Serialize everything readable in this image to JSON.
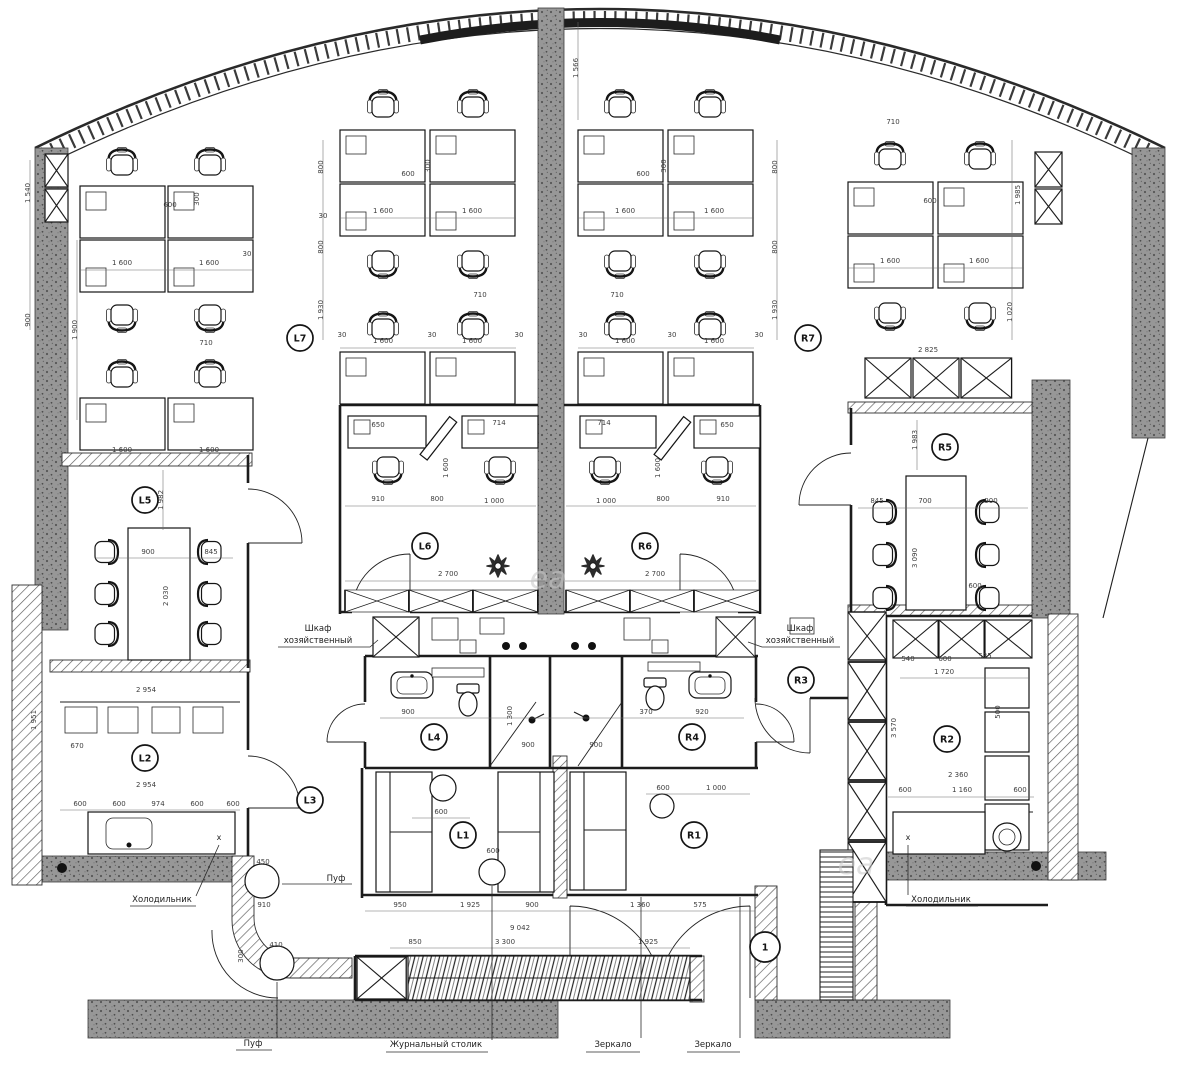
{
  "plan": {
    "title_hint": "office floor plan",
    "colors": {
      "concrete": "#979797",
      "speckle": "#555555",
      "line": "#1c1c1c",
      "hatch": "#5a5a5a"
    }
  },
  "annotations": {
    "utility_cabinet_line1": "Шкаф",
    "utility_cabinet_line2": "хозяйственный",
    "pouf": "Пуф",
    "pouf2": "Пуф",
    "coffee_table": "Журнальный столик",
    "mirror1": "Зеркало",
    "mirror2": "Зеркало",
    "fridge_left": "Холодильник",
    "fridge_right": "Холодильник",
    "x_mark": "x",
    "watermark_fragment": "еа"
  },
  "rooms": [
    {
      "id": "L7",
      "x": 300,
      "y": 338,
      "r": 13
    },
    {
      "id": "R7",
      "x": 808,
      "y": 338,
      "r": 13
    },
    {
      "id": "L6",
      "x": 425,
      "y": 546,
      "r": 13
    },
    {
      "id": "R6",
      "x": 645,
      "y": 546,
      "r": 13
    },
    {
      "id": "L5",
      "x": 145,
      "y": 500,
      "r": 13
    },
    {
      "id": "R5",
      "x": 945,
      "y": 447,
      "r": 13
    },
    {
      "id": "L4",
      "x": 434,
      "y": 737,
      "r": 13
    },
    {
      "id": "R4",
      "x": 692,
      "y": 737,
      "r": 13
    },
    {
      "id": "L3",
      "x": 310,
      "y": 800,
      "r": 13
    },
    {
      "id": "R3",
      "x": 801,
      "y": 680,
      "r": 13
    },
    {
      "id": "L2",
      "x": 145,
      "y": 758,
      "r": 13
    },
    {
      "id": "R2",
      "x": 947,
      "y": 739,
      "r": 13
    },
    {
      "id": "L1",
      "x": 463,
      "y": 835,
      "r": 13
    },
    {
      "id": "R1",
      "x": 694,
      "y": 835,
      "r": 13
    },
    {
      "id": "1",
      "x": 765,
      "y": 947,
      "r": 15
    }
  ],
  "dimensions": [
    {
      "v": "1 540",
      "x": 30,
      "y": 193,
      "r": -90
    },
    {
      "v": "900",
      "x": 30,
      "y": 320,
      "r": -90
    },
    {
      "v": "1 900",
      "x": 77,
      "y": 330,
      "r": -90
    },
    {
      "v": "600",
      "x": 170,
      "y": 207,
      "r": 0
    },
    {
      "v": "300",
      "x": 199,
      "y": 199,
      "r": -90
    },
    {
      "v": "1 600",
      "x": 122,
      "y": 265,
      "r": 0
    },
    {
      "v": "1 600",
      "x": 209,
      "y": 265,
      "r": 0
    },
    {
      "v": "30",
      "x": 247,
      "y": 256,
      "r": 0
    },
    {
      "v": "710",
      "x": 206,
      "y": 345,
      "r": 0
    },
    {
      "v": "1 600",
      "x": 122,
      "y": 452,
      "r": 0
    },
    {
      "v": "1 600",
      "x": 209,
      "y": 452,
      "r": 0
    },
    {
      "v": "800",
      "x": 323,
      "y": 167,
      "r": -90
    },
    {
      "v": "800",
      "x": 323,
      "y": 247,
      "r": -90
    },
    {
      "v": "1 930",
      "x": 323,
      "y": 310,
      "r": -90
    },
    {
      "v": "30",
      "x": 323,
      "y": 218,
      "r": 0
    },
    {
      "v": "600",
      "x": 408,
      "y": 176,
      "r": 0
    },
    {
      "v": "300",
      "x": 430,
      "y": 166,
      "r": -90
    },
    {
      "v": "1 600",
      "x": 383,
      "y": 213,
      "r": 0
    },
    {
      "v": "1 600",
      "x": 472,
      "y": 213,
      "r": 0
    },
    {
      "v": "1 566",
      "x": 578,
      "y": 68,
      "r": -90
    },
    {
      "v": "1 600",
      "x": 625,
      "y": 213,
      "r": 0
    },
    {
      "v": "1 600",
      "x": 714,
      "y": 213,
      "r": 0
    },
    {
      "v": "600",
      "x": 643,
      "y": 176,
      "r": 0
    },
    {
      "v": "300",
      "x": 666,
      "y": 166,
      "r": -90
    },
    {
      "v": "800",
      "x": 777,
      "y": 167,
      "r": -90
    },
    {
      "v": "800",
      "x": 777,
      "y": 247,
      "r": -90
    },
    {
      "v": "1 930",
      "x": 777,
      "y": 310,
      "r": -90
    },
    {
      "v": "710",
      "x": 480,
      "y": 297,
      "r": 0
    },
    {
      "v": "710",
      "x": 617,
      "y": 297,
      "r": 0
    },
    {
      "v": "30",
      "x": 342,
      "y": 337,
      "r": 0
    },
    {
      "v": "30",
      "x": 432,
      "y": 337,
      "r": 0
    },
    {
      "v": "30",
      "x": 519,
      "y": 337,
      "r": 0
    },
    {
      "v": "1 600",
      "x": 383,
      "y": 343,
      "r": 0
    },
    {
      "v": "1 600",
      "x": 472,
      "y": 343,
      "r": 0
    },
    {
      "v": "1 600",
      "x": 625,
      "y": 343,
      "r": 0
    },
    {
      "v": "1 600",
      "x": 714,
      "y": 343,
      "r": 0
    },
    {
      "v": "30",
      "x": 583,
      "y": 337,
      "r": 0
    },
    {
      "v": "30",
      "x": 672,
      "y": 337,
      "r": 0
    },
    {
      "v": "30",
      "x": 759,
      "y": 337,
      "r": 0
    },
    {
      "v": "710",
      "x": 893,
      "y": 124,
      "r": 0
    },
    {
      "v": "1 600",
      "x": 890,
      "y": 263,
      "r": 0
    },
    {
      "v": "1 600",
      "x": 979,
      "y": 263,
      "r": 0
    },
    {
      "v": "600",
      "x": 930,
      "y": 203,
      "r": 0
    },
    {
      "v": "1 985",
      "x": 1020,
      "y": 195,
      "r": -90
    },
    {
      "v": "1 020",
      "x": 1012,
      "y": 312,
      "r": -90
    },
    {
      "v": "2 825",
      "x": 928,
      "y": 352,
      "r": 0
    },
    {
      "v": "1 982",
      "x": 163,
      "y": 500,
      "r": -90
    },
    {
      "v": "900",
      "x": 148,
      "y": 554,
      "r": 0
    },
    {
      "v": "845",
      "x": 211,
      "y": 554,
      "r": 0
    },
    {
      "v": "2 030",
      "x": 168,
      "y": 596,
      "r": -90
    },
    {
      "v": "1 983",
      "x": 917,
      "y": 440,
      "r": -90
    },
    {
      "v": "845",
      "x": 877,
      "y": 503,
      "r": 0
    },
    {
      "v": "700",
      "x": 925,
      "y": 503,
      "r": 0
    },
    {
      "v": "900",
      "x": 991,
      "y": 503,
      "r": 0
    },
    {
      "v": "3 090",
      "x": 917,
      "y": 558,
      "r": -90
    },
    {
      "v": "600",
      "x": 975,
      "y": 588,
      "r": 0
    },
    {
      "v": "650",
      "x": 378,
      "y": 427,
      "r": 0
    },
    {
      "v": "714",
      "x": 499,
      "y": 425,
      "r": 0
    },
    {
      "v": "714",
      "x": 604,
      "y": 425,
      "r": 0
    },
    {
      "v": "650",
      "x": 727,
      "y": 427,
      "r": 0
    },
    {
      "v": "1 600",
      "x": 448,
      "y": 468,
      "r": -90
    },
    {
      "v": "1 600",
      "x": 660,
      "y": 468,
      "r": -90
    },
    {
      "v": "910",
      "x": 378,
      "y": 501,
      "r": 0
    },
    {
      "v": "800",
      "x": 437,
      "y": 501,
      "r": 0
    },
    {
      "v": "1 000",
      "x": 494,
      "y": 503,
      "r": 0
    },
    {
      "v": "1 000",
      "x": 606,
      "y": 503,
      "r": 0
    },
    {
      "v": "800",
      "x": 663,
      "y": 501,
      "r": 0
    },
    {
      "v": "910",
      "x": 723,
      "y": 501,
      "r": 0
    },
    {
      "v": "2 700",
      "x": 448,
      "y": 576,
      "r": 0
    },
    {
      "v": "2 700",
      "x": 655,
      "y": 576,
      "r": 0
    },
    {
      "v": "900",
      "x": 408,
      "y": 714,
      "r": 0
    },
    {
      "v": "370",
      "x": 646,
      "y": 714,
      "r": 0
    },
    {
      "v": "920",
      "x": 702,
      "y": 714,
      "r": 0
    },
    {
      "v": "1 300",
      "x": 512,
      "y": 716,
      "r": -90
    },
    {
      "v": "900",
      "x": 528,
      "y": 747,
      "r": 0
    },
    {
      "v": "900",
      "x": 596,
      "y": 747,
      "r": 0
    },
    {
      "v": "2 954",
      "x": 146,
      "y": 692,
      "r": 0
    },
    {
      "v": "670",
      "x": 77,
      "y": 748,
      "r": 0
    },
    {
      "v": "2 954",
      "x": 146,
      "y": 787,
      "r": 0
    },
    {
      "v": "1 951",
      "x": 36,
      "y": 720,
      "r": -90
    },
    {
      "v": "600",
      "x": 80,
      "y": 806,
      "r": 0
    },
    {
      "v": "600",
      "x": 119,
      "y": 806,
      "r": 0
    },
    {
      "v": "974",
      "x": 158,
      "y": 806,
      "r": 0
    },
    {
      "v": "600",
      "x": 197,
      "y": 806,
      "r": 0
    },
    {
      "v": "600",
      "x": 233,
      "y": 806,
      "r": 0
    },
    {
      "v": "540",
      "x": 908,
      "y": 661,
      "r": 0
    },
    {
      "v": "600",
      "x": 945,
      "y": 661,
      "r": 0
    },
    {
      "v": "535",
      "x": 985,
      "y": 658,
      "r": 0
    },
    {
      "v": "1 720",
      "x": 944,
      "y": 674,
      "r": 0
    },
    {
      "v": "3 570",
      "x": 896,
      "y": 728,
      "r": -90
    },
    {
      "v": "500",
      "x": 1000,
      "y": 712,
      "r": -90
    },
    {
      "v": "2 360",
      "x": 958,
      "y": 777,
      "r": 0
    },
    {
      "v": "600",
      "x": 905,
      "y": 792,
      "r": 0
    },
    {
      "v": "1 160",
      "x": 962,
      "y": 792,
      "r": 0
    },
    {
      "v": "600",
      "x": 1020,
      "y": 792,
      "r": 0
    },
    {
      "v": "600",
      "x": 663,
      "y": 790,
      "r": 0
    },
    {
      "v": "1 000",
      "x": 716,
      "y": 790,
      "r": 0
    },
    {
      "v": "600",
      "x": 441,
      "y": 814,
      "r": 0
    },
    {
      "v": "600",
      "x": 493,
      "y": 853,
      "r": 0
    },
    {
      "v": "450",
      "x": 263,
      "y": 864,
      "r": 0
    },
    {
      "v": "910",
      "x": 264,
      "y": 907,
      "r": 0
    },
    {
      "v": "410",
      "x": 276,
      "y": 947,
      "r": 0
    },
    {
      "v": "300",
      "x": 243,
      "y": 956,
      "r": -90
    },
    {
      "v": "950",
      "x": 400,
      "y": 907,
      "r": 0
    },
    {
      "v": "1 925",
      "x": 470,
      "y": 907,
      "r": 0
    },
    {
      "v": "900",
      "x": 532,
      "y": 907,
      "r": 0
    },
    {
      "v": "1 360",
      "x": 640,
      "y": 907,
      "r": 0
    },
    {
      "v": "575",
      "x": 700,
      "y": 907,
      "r": 0
    },
    {
      "v": "9 042",
      "x": 520,
      "y": 930,
      "r": 0
    },
    {
      "v": "850",
      "x": 415,
      "y": 944,
      "r": 0
    },
    {
      "v": "3 300",
      "x": 505,
      "y": 944,
      "r": 0
    },
    {
      "v": "1 925",
      "x": 648,
      "y": 944,
      "r": 0
    }
  ]
}
